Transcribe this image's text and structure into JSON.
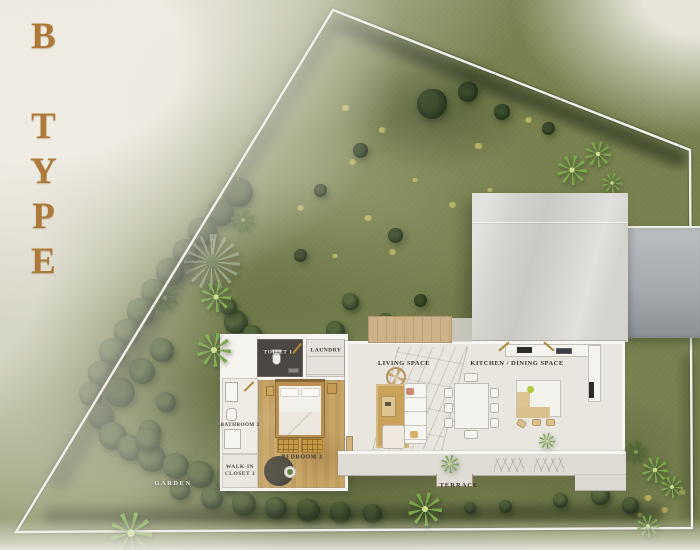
{
  "plan": {
    "type_label": "B TYPE",
    "rooms": [
      {
        "id": "toilet-1",
        "label": "TOILET 1"
      },
      {
        "id": "laundry",
        "label": "LAUNDRY"
      },
      {
        "id": "living-space",
        "label": "LIVING SPACE"
      },
      {
        "id": "kitchen-dining",
        "label": "KITCHEN / DINING SPACE"
      },
      {
        "id": "bathroom-3",
        "label": "BATHROOM 3"
      },
      {
        "id": "walk-in-closet-3",
        "label": "WALK-IN CLOSET 3"
      },
      {
        "id": "bedroom-3",
        "label": "BEDROOM 3"
      },
      {
        "id": "garden",
        "label": "GARDEN"
      },
      {
        "id": "terrace",
        "label": "TERRACE"
      }
    ]
  },
  "colors": {
    "accent_gold": "#ad7a3a",
    "grass": "#79824f",
    "hedge_dark": "#24321c",
    "roof": "#d5d3ce",
    "driveway": "#9aa0a5",
    "wood_floor": "#c9a565",
    "toilet_dark": "#4b4742",
    "terrace": "#dfdcd5",
    "boundary_line": "#f4f2ec",
    "label_dark": "#3a352e",
    "label_light": "#f5f3ec"
  }
}
